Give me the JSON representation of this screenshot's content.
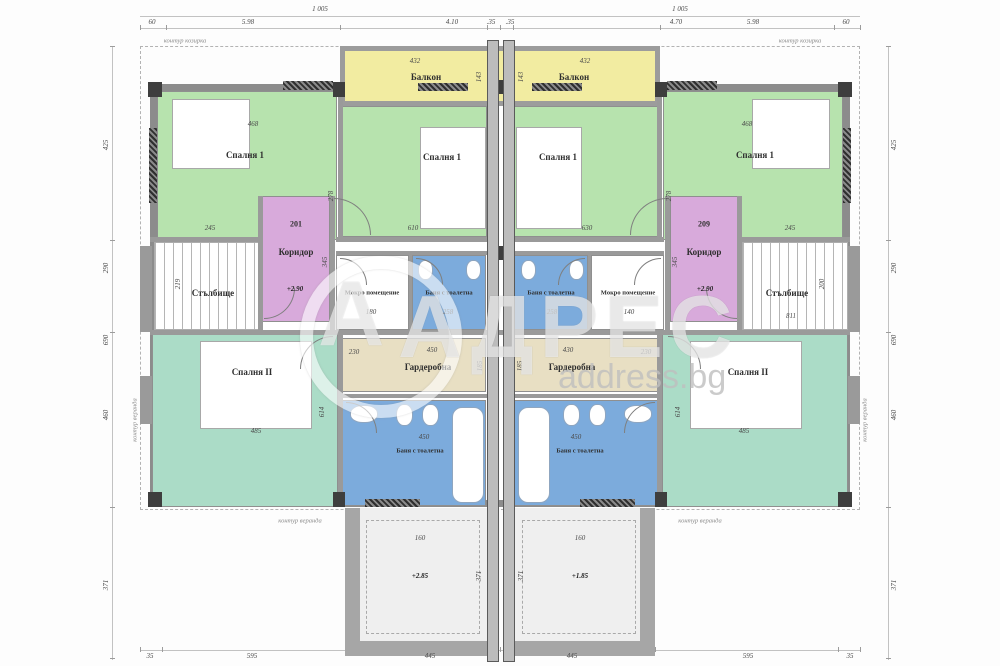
{
  "watermark": {
    "brand": "АДРЕС",
    "site": "address.bg",
    "logo_letter": "А"
  },
  "colors": {
    "bedroom_green": "#b7e3ae",
    "balcony_yellow": "#f2eca1",
    "corridor_pink": "#d8aadb",
    "bath_blue": "#7cabdc",
    "bedroom2_teal": "#abdcc7",
    "wardrobe_tan": "#e8dfc3"
  },
  "annotations": {
    "canopy_top_left": "контур козирка",
    "canopy_top_right": "контур козирка",
    "veranda_bottom_left": "контур веранда",
    "veranda_bottom_right": "контур веранда",
    "veranda_side_left": "контур веранда",
    "veranda_side_right": "контур веранда"
  },
  "dimensions": {
    "top_overall_left": "1 005",
    "top_overall_right": "1 005",
    "top_segments": [
      "60",
      "5.98",
      "4.10",
      ".35",
      ".35",
      "4.70",
      "5.98",
      "60"
    ],
    "bottom_segments": [
      "35",
      "595",
      "445",
      "445",
      "595",
      "35"
    ],
    "left_vertical": [
      "425",
      "290",
      "690",
      "460",
      "371"
    ],
    "right_vertical": [
      "425",
      "290",
      "690",
      "460",
      "371"
    ]
  },
  "units": {
    "left": {
      "bedroom1_outer": {
        "name": "Спалня 1",
        "dim_w": "468",
        "dim_b": "245",
        "dim_side": "278"
      },
      "balcony": {
        "name": "Балкон",
        "dim_w": "432",
        "dim_d": "143"
      },
      "bedroom1_inner": {
        "name": "Спалня 1",
        "dim_b": "610"
      },
      "corridor": {
        "number": "201",
        "name": "Коридор",
        "level": "+2.90",
        "dim_side": "345"
      },
      "staircase": {
        "name": "Стълбище",
        "dim_side": "219"
      },
      "utility": {
        "name": "Мокро помещение",
        "dim": "180"
      },
      "bath_small": {
        "name": "Баня с тоалетна",
        "dim": "258"
      },
      "wardrobe": {
        "name": "Гардеробна",
        "dim_w": "450",
        "dim_side": "185",
        "dim_l": "230"
      },
      "bath_large": {
        "name": "Баня с тоалетна",
        "dim_w": "450"
      },
      "bedroom2": {
        "name": "Спалня II",
        "dim_w": "485",
        "dim_side": "614"
      },
      "patio": {
        "level": "+2.85",
        "dim_w": "160",
        "dim_side": "371"
      }
    },
    "right": {
      "bedroom1_outer": {
        "name": "Спалня 1",
        "dim_w": "468",
        "dim_b": "245",
        "dim_side": "278"
      },
      "balcony": {
        "name": "Балкон",
        "dim_w": "432",
        "dim_d": "143"
      },
      "bedroom1_inner": {
        "name": "Спалня 1",
        "dim_b": "630"
      },
      "corridor": {
        "number": "209",
        "name": "Коридор",
        "level": "+2.90",
        "dim_side": "345"
      },
      "staircase": {
        "name": "Стълбище",
        "dim_w": "811",
        "dim_side": "200"
      },
      "utility": {
        "name": "Мокро помещение",
        "dim": "140"
      },
      "bath_small": {
        "name": "Баня с тоалетна",
        "dim": "258"
      },
      "wardrobe": {
        "name": "Гардеробна",
        "dim_w": "430",
        "dim_side": "185",
        "dim_l": "230"
      },
      "bath_large": {
        "name": "Баня с тоалетна",
        "dim_w": "450"
      },
      "bedroom2": {
        "name": "Спалня II",
        "dim_w": "485",
        "dim_side": "614"
      },
      "patio": {
        "level": "+1.85",
        "dim_w": "160",
        "dim_side": "371"
      }
    }
  }
}
